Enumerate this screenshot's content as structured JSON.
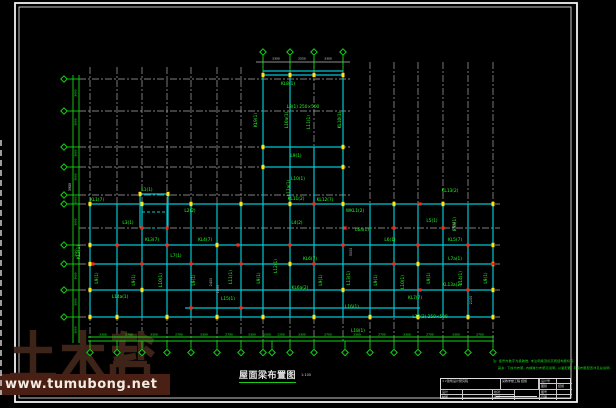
{
  "watermark": {
    "logo_text": "土木帮",
    "url_text": "www.tumubong.net",
    "logo_color": "#41251b",
    "strip_color": "#4a2015"
  },
  "title": {
    "text": "屋面梁布置图",
    "scale": "1:100"
  },
  "notes": {
    "line1": "注: 括号内数字为梁跨数, 未注明梁顶标高同结构层标高.",
    "line2": "其余: 下柱均布筋, 内横跨分布筋见说明, 以梁配筋, 平面布筋配置详见总说明."
  },
  "title_block": {
    "company": "××建筑设计研究院",
    "project": "某教学楼工程 结施",
    "row_labels": [
      "设计号",
      "图别",
      "图号",
      "日期"
    ],
    "row_values": [
      "",
      "结施",
      "",
      ""
    ],
    "sign_labels": {
      "r1c1": "设计",
      "r1c3": "校对",
      "r2c1": "制图",
      "r2c3": "审核"
    }
  },
  "colors": {
    "grid": "#a9a9a9",
    "beam": "#00c8d2",
    "axis_green": "#12d412",
    "label_green": "#24ff24",
    "yellow": "#ffe31a",
    "red": "#ff2416",
    "white": "#e8e8e8",
    "frame": "#f2f2f2"
  },
  "drawing": {
    "frame": {
      "outer": [
        15,
        3,
        562,
        399
      ],
      "inner": [
        19,
        7,
        552,
        391
      ]
    },
    "grid": {
      "v": [
        [
          90,
          67,
          343
        ],
        [
          117,
          67,
          343
        ],
        [
          142,
          67,
          343
        ],
        [
          167,
          67,
          343
        ],
        [
          191,
          67,
          343
        ],
        [
          217,
          67,
          343
        ],
        [
          241,
          67,
          343
        ],
        [
          263,
          57,
          343
        ],
        [
          290,
          57,
          343
        ],
        [
          314,
          57,
          343
        ],
        [
          343,
          57,
          343
        ],
        [
          370,
          62,
          343
        ],
        [
          394,
          62,
          343
        ],
        [
          418,
          62,
          343
        ],
        [
          443,
          62,
          343
        ],
        [
          468,
          62,
          343
        ],
        [
          493,
          62,
          343
        ]
      ],
      "h": [
        [
          79,
          79,
          350
        ],
        [
          111,
          79,
          350
        ],
        [
          147,
          79,
          350
        ],
        [
          167,
          79,
          350
        ],
        [
          195,
          79,
          350
        ],
        [
          204,
          79,
          500
        ],
        [
          228,
          79,
          500
        ],
        [
          245,
          79,
          500
        ],
        [
          264,
          79,
          500
        ],
        [
          290,
          79,
          500
        ],
        [
          317,
          79,
          500
        ]
      ]
    },
    "beams": [
      [
        90,
        204,
        493,
        204
      ],
      [
        90,
        245,
        493,
        245
      ],
      [
        90,
        264,
        493,
        264
      ],
      [
        90,
        290,
        493,
        290
      ],
      [
        90,
        317,
        493,
        317
      ],
      [
        185,
        308,
        420,
        308
      ],
      [
        90,
        204,
        90,
        317
      ],
      [
        117,
        204,
        117,
        317
      ],
      [
        142,
        204,
        142,
        317
      ],
      [
        167,
        204,
        167,
        317
      ],
      [
        191,
        204,
        191,
        317
      ],
      [
        217,
        204,
        217,
        317
      ],
      [
        241,
        204,
        241,
        317
      ],
      [
        263,
        204,
        263,
        317
      ],
      [
        290,
        204,
        290,
        317
      ],
      [
        314,
        204,
        314,
        317
      ],
      [
        343,
        204,
        343,
        317
      ],
      [
        370,
        204,
        370,
        317
      ],
      [
        394,
        204,
        394,
        317
      ],
      [
        418,
        204,
        418,
        317
      ],
      [
        443,
        204,
        443,
        317
      ],
      [
        468,
        204,
        468,
        317
      ],
      [
        493,
        204,
        493,
        317
      ],
      [
        263,
        75,
        263,
        204
      ],
      [
        343,
        75,
        343,
        204
      ],
      [
        290,
        75,
        290,
        204
      ],
      [
        314,
        147,
        314,
        204
      ],
      [
        263,
        75,
        343,
        75
      ],
      [
        263,
        71,
        343,
        71
      ],
      [
        263,
        147,
        343,
        147
      ],
      [
        263,
        167,
        343,
        167
      ],
      [
        140,
        194,
        168,
        194
      ],
      [
        140,
        194,
        140,
        228
      ],
      [
        168,
        194,
        168,
        228
      ]
    ],
    "beams_dashed": [
      [
        142,
        228,
        166,
        228
      ],
      [
        142,
        212,
        166,
        212
      ]
    ],
    "axis": {
      "left": {
        "bubble_x": 64,
        "line_x1": 73,
        "line_x2": 79,
        "y_top": 75,
        "y_bot": 343,
        "ys": [
          79,
          111,
          147,
          167,
          195,
          204,
          245,
          264,
          290,
          317
        ]
      },
      "bottom": {
        "bubble_y": 352.5,
        "line_y1": 337,
        "line_y2": 341,
        "x1": 88,
        "x2": 494,
        "xs": [
          90,
          117,
          142,
          167,
          191,
          217,
          241,
          263,
          272,
          290,
          314,
          345,
          370,
          394,
          418,
          443,
          468,
          493
        ]
      },
      "top": {
        "bubble_y": 52,
        "stem_y2": 71,
        "xs": [
          263,
          290,
          314,
          343
        ],
        "dim_line": [
          256,
          62,
          350,
          62
        ]
      }
    },
    "marks": {
      "yellow": [
        [
          90,
          204
        ],
        [
          142,
          204
        ],
        [
          191,
          204
        ],
        [
          241,
          204
        ],
        [
          290,
          204
        ],
        [
          343,
          204
        ],
        [
          394,
          204
        ],
        [
          443,
          204
        ],
        [
          493,
          204
        ],
        [
          90,
          317
        ],
        [
          117,
          317
        ],
        [
          167,
          317
        ],
        [
          217,
          317
        ],
        [
          263,
          317
        ],
        [
          314,
          317
        ],
        [
          370,
          317
        ],
        [
          418,
          317
        ],
        [
          468,
          317
        ],
        [
          493,
          317
        ],
        [
          263,
          75
        ],
        [
          290,
          75
        ],
        [
          314,
          75
        ],
        [
          343,
          75
        ],
        [
          263,
          147
        ],
        [
          343,
          147
        ],
        [
          263,
          167
        ],
        [
          343,
          167
        ],
        [
          90,
          245
        ],
        [
          90,
          264
        ],
        [
          90,
          290
        ],
        [
          493,
          245
        ],
        [
          493,
          264
        ],
        [
          493,
          290
        ],
        [
          140,
          194
        ],
        [
          168,
          194
        ],
        [
          217,
          245
        ],
        [
          290,
          264
        ],
        [
          418,
          264
        ],
        [
          142,
          290
        ],
        [
          343,
          290
        ]
      ],
      "red": [
        [
          142,
          228
        ],
        [
          167,
          228
        ],
        [
          345,
          228
        ],
        [
          394,
          228
        ],
        [
          443,
          228
        ],
        [
          117,
          245
        ],
        [
          167,
          245
        ],
        [
          238,
          245
        ],
        [
          290,
          245
        ],
        [
          343,
          245
        ],
        [
          418,
          245
        ],
        [
          468,
          245
        ],
        [
          93,
          264
        ],
        [
          142,
          264
        ],
        [
          191,
          264
        ],
        [
          241,
          264
        ],
        [
          314,
          264
        ],
        [
          394,
          264
        ],
        [
          493,
          264
        ],
        [
          314,
          204
        ],
        [
          420,
          204
        ],
        [
          468,
          290
        ],
        [
          191,
          308
        ],
        [
          241,
          308
        ],
        [
          420,
          290
        ]
      ]
    },
    "labels": [
      {
        "x": 288,
        "y": 85,
        "t": "KL8(1)"
      },
      {
        "x": 303,
        "y": 108,
        "t": "L8(1) 250×500"
      },
      {
        "x": 296,
        "y": 157,
        "t": "L9(1)"
      },
      {
        "x": 298,
        "y": 180,
        "t": "L10(1)"
      },
      {
        "x": 296,
        "y": 200,
        "t": "KL11(2)"
      },
      {
        "x": 257,
        "y": 120,
        "t": "KL9(1)",
        "r": 1
      },
      {
        "x": 288,
        "y": 120,
        "t": "L10a(1)",
        "r": 1
      },
      {
        "x": 310,
        "y": 122,
        "t": "L11(1)",
        "r": 1
      },
      {
        "x": 341,
        "y": 120,
        "t": "KL10(1)",
        "r": 1
      },
      {
        "x": 290,
        "y": 188,
        "t": "L12a(1)",
        "r": 1
      },
      {
        "x": 97,
        "y": 201,
        "t": "KL1(7)"
      },
      {
        "x": 147,
        "y": 191,
        "t": "L1(1)"
      },
      {
        "x": 190,
        "y": 212,
        "t": "L2(2)"
      },
      {
        "x": 325,
        "y": 201,
        "t": "KL12(7)"
      },
      {
        "x": 355,
        "y": 212,
        "t": "WKL1(2)"
      },
      {
        "x": 450,
        "y": 192,
        "t": "KL13(2)"
      },
      {
        "x": 128,
        "y": 224,
        "t": "L3(1)"
      },
      {
        "x": 297,
        "y": 224,
        "t": "L4(2)"
      },
      {
        "x": 432,
        "y": 222,
        "t": "L5(1)"
      },
      {
        "x": 152,
        "y": 241,
        "t": "KL3(7)"
      },
      {
        "x": 205,
        "y": 241,
        "t": "KL4(7)"
      },
      {
        "x": 390,
        "y": 241,
        "t": "L6(1)"
      },
      {
        "x": 455,
        "y": 241,
        "t": "KL5(7)"
      },
      {
        "x": 362,
        "y": 231,
        "t": "L6a(1)"
      },
      {
        "x": 176,
        "y": 257,
        "t": "L7(1)"
      },
      {
        "x": 310,
        "y": 260,
        "t": "KL6(7)"
      },
      {
        "x": 455,
        "y": 260,
        "t": "L7a(1)"
      },
      {
        "x": 80,
        "y": 252,
        "t": "KL2(1)",
        "r": 1
      },
      {
        "x": 98,
        "y": 278,
        "t": "L9(1)",
        "r": 1
      },
      {
        "x": 135,
        "y": 280,
        "t": "L9(1)",
        "r": 1
      },
      {
        "x": 162,
        "y": 280,
        "t": "L10(1)",
        "r": 1
      },
      {
        "x": 195,
        "y": 280,
        "t": "L9(1)",
        "r": 1
      },
      {
        "x": 232,
        "y": 277,
        "t": "L11(1)",
        "r": 1
      },
      {
        "x": 260,
        "y": 278,
        "t": "L9(1)",
        "r": 1
      },
      {
        "x": 277,
        "y": 266,
        "t": "L12(1)",
        "r": 1
      },
      {
        "x": 322,
        "y": 280,
        "t": "L9(1)",
        "r": 1
      },
      {
        "x": 350,
        "y": 278,
        "t": "L13(1)",
        "r": 1
      },
      {
        "x": 377,
        "y": 280,
        "t": "L9(1)",
        "r": 1
      },
      {
        "x": 404,
        "y": 282,
        "t": "L10(1)",
        "r": 1
      },
      {
        "x": 430,
        "y": 278,
        "t": "L9(1)",
        "r": 1
      },
      {
        "x": 462,
        "y": 278,
        "t": "L14(1)",
        "r": 1
      },
      {
        "x": 487,
        "y": 278,
        "t": "L9(1)",
        "r": 1
      },
      {
        "x": 456,
        "y": 224,
        "t": "L5a(1)",
        "r": 1
      },
      {
        "x": 300,
        "y": 289,
        "t": "KL6a(2)"
      },
      {
        "x": 120,
        "y": 298,
        "t": "L14a(1)"
      },
      {
        "x": 452,
        "y": 286,
        "t": "KL13a(2)"
      },
      {
        "x": 228,
        "y": 300,
        "t": "L15(1)"
      },
      {
        "x": 352,
        "y": 308,
        "t": "L16(1)"
      },
      {
        "x": 430,
        "y": 318,
        "t": "L17(3) 250×500"
      },
      {
        "x": 358,
        "y": 332,
        "t": "L18(1)"
      },
      {
        "x": 415,
        "y": 299,
        "t": "KL7(7)"
      },
      {
        "x": 212,
        "y": 282,
        "t": "2400",
        "c": "#c9c9c9",
        "s": 3.4,
        "r": 1
      },
      {
        "x": 219,
        "y": 289,
        "t": "1500",
        "c": "#c9c9c9",
        "s": 3.4,
        "r": 1
      },
      {
        "x": 455,
        "y": 226,
        "t": "1800",
        "c": "#c9c9c9",
        "s": 3.4,
        "r": 1
      },
      {
        "x": 472,
        "y": 300,
        "t": "2100",
        "c": "#c9c9c9",
        "s": 3.4,
        "r": 1
      },
      {
        "x": 352,
        "y": 252,
        "t": "3000",
        "c": "#c9c9c9",
        "s": 3.4,
        "r": 1
      },
      {
        "x": 71,
        "y": 187,
        "t": "3900",
        "c": "#dddddd",
        "s": 3.2,
        "r": 1
      },
      {
        "x": 276,
        "y": 59.5,
        "t": "3300",
        "c": "#dddddd",
        "s": 3
      },
      {
        "x": 302,
        "y": 59.5,
        "t": "2550",
        "c": "#dddddd",
        "s": 3
      },
      {
        "x": 328,
        "y": 59.5,
        "t": "3300",
        "c": "#dddddd",
        "s": 3
      }
    ],
    "left_dims": {
      "x": 76.5,
      "ys": [
        93,
        122,
        153,
        177,
        200,
        222,
        253,
        276,
        302,
        330
      ],
      "texts": [
        "3600",
        "3000",
        "3600",
        "3000",
        "3600",
        "3000",
        "3600",
        "3000",
        "3600",
        "3000"
      ]
    },
    "bottom_dims": {
      "y": 335.5,
      "items": [
        [
          103,
          "3300"
        ],
        [
          129,
          "2700"
        ],
        [
          154,
          "3300"
        ],
        [
          179,
          "2700"
        ],
        [
          204,
          "3300"
        ],
        [
          229,
          "2700"
        ],
        [
          252,
          "3300"
        ],
        [
          267,
          "1500"
        ],
        [
          281,
          "1200"
        ],
        [
          302,
          "3300"
        ],
        [
          328,
          "2700"
        ],
        [
          357,
          "3300"
        ],
        [
          382,
          "2700"
        ],
        [
          407,
          "3300"
        ],
        [
          430,
          "2700"
        ],
        [
          456,
          "3300"
        ],
        [
          480,
          "2700"
        ]
      ]
    }
  }
}
